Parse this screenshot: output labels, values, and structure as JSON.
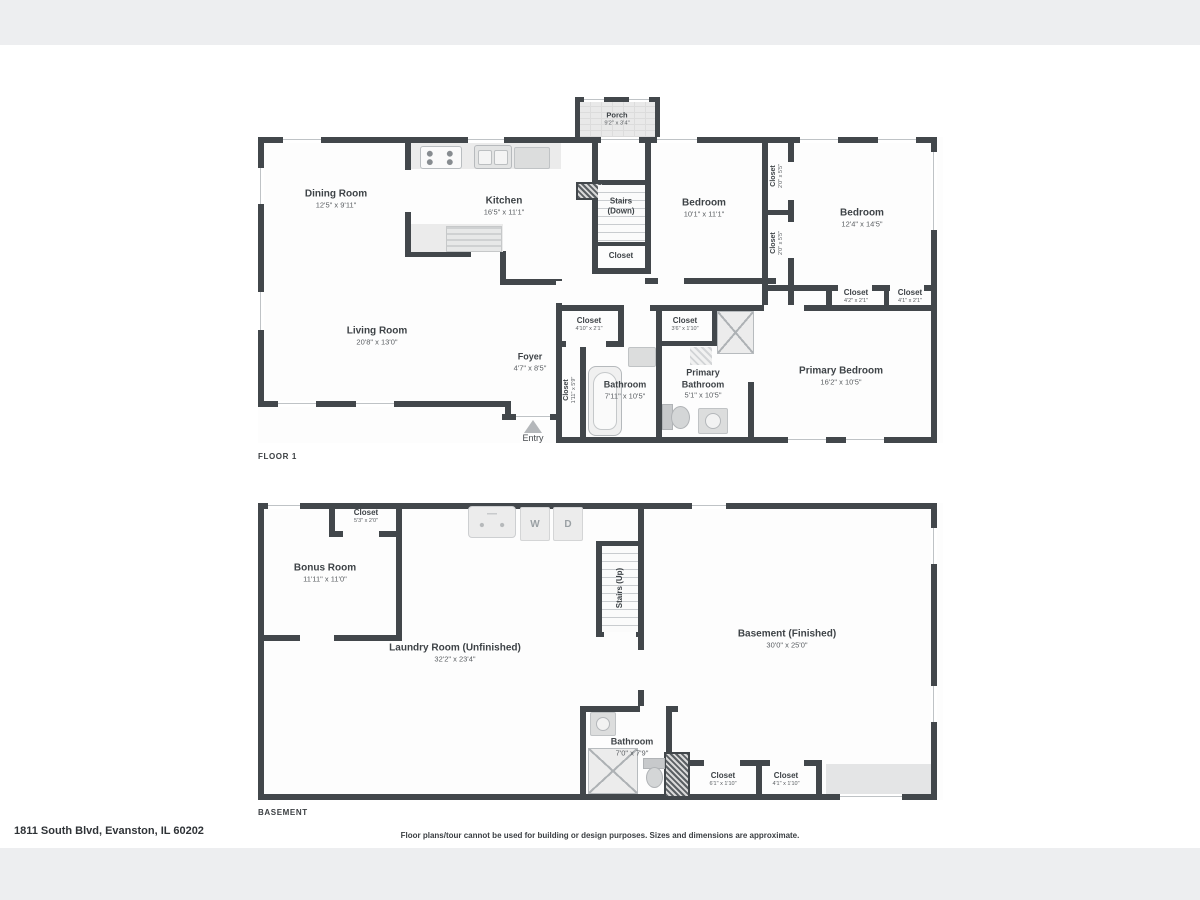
{
  "address": "1811 South Blvd, Evanston, IL 60202",
  "disclaimer": "Floor plans/tour cannot be used for building or design purposes. Sizes and dimensions are approximate.",
  "floor1": {
    "title": "FLOOR 1",
    "entry": "Entry",
    "porch": {
      "name": "Porch",
      "dims": "9'2\" x 3'4\""
    },
    "dining": {
      "name": "Dining Room",
      "dims": "12'5\" x 9'11\""
    },
    "kitchen": {
      "name": "Kitchen",
      "dims": "16'5\" x 11'1\""
    },
    "stairs": {
      "name": "Stairs (Down)"
    },
    "stairs_closet": {
      "name": "Closet"
    },
    "bedroom1": {
      "name": "Bedroom",
      "dims": "10'1\" x 11'1\""
    },
    "closet_b1a": {
      "name": "Closet",
      "dims": "2'0\" x 5'5\""
    },
    "closet_b1b": {
      "name": "Closet",
      "dims": "2'0\" x 5'5\""
    },
    "bedroom2": {
      "name": "Bedroom",
      "dims": "12'4\" x 14'5\""
    },
    "closet_b2a": {
      "name": "Closet",
      "dims": "4'2\" x 2'1\""
    },
    "closet_b2b": {
      "name": "Closet",
      "dims": "4'1\" x 2'1\""
    },
    "living": {
      "name": "Living Room",
      "dims": "20'8\" x 13'0\""
    },
    "foyer": {
      "name": "Foyer",
      "dims": "4'7\" x 8'5\""
    },
    "closet_foyer": {
      "name": "Closet",
      "dims": "1'11\" x 5'9\""
    },
    "closet_hall": {
      "name": "Closet",
      "dims": "4'10\" x 2'1\""
    },
    "closet_bath": {
      "name": "Closet",
      "dims": "3'6\" x 1'10\""
    },
    "bathroom": {
      "name": "Bathroom",
      "dims": "7'11\" x 10'5\""
    },
    "primary_bathroom": {
      "name": "Primary Bathroom",
      "dims": "5'1\" x 10'5\""
    },
    "primary_bedroom": {
      "name": "Primary Bedroom",
      "dims": "16'2\" x 10'5\""
    }
  },
  "basement": {
    "title": "BASEMENT",
    "washer": "W",
    "dryer": "D",
    "closet_bonus": {
      "name": "Closet",
      "dims": "5'3\" x 2'0\""
    },
    "bonus": {
      "name": "Bonus Room",
      "dims": "11'11\" x 11'0\""
    },
    "stairs": {
      "name": "Stairs (Up)"
    },
    "laundry": {
      "name": "Laundry Room (Unfinished)",
      "dims": "32'2\" x 23'4\""
    },
    "finished": {
      "name": "Basement (Finished)",
      "dims": "30'0\" x 25'0\""
    },
    "bathroom": {
      "name": "Bathroom",
      "dims": "7'0\" x 7'9\""
    },
    "closet_a": {
      "name": "Closet",
      "dims": "6'1\" x 1'10\""
    },
    "closet_b": {
      "name": "Closet",
      "dims": "4'1\" x 1'10\""
    }
  }
}
